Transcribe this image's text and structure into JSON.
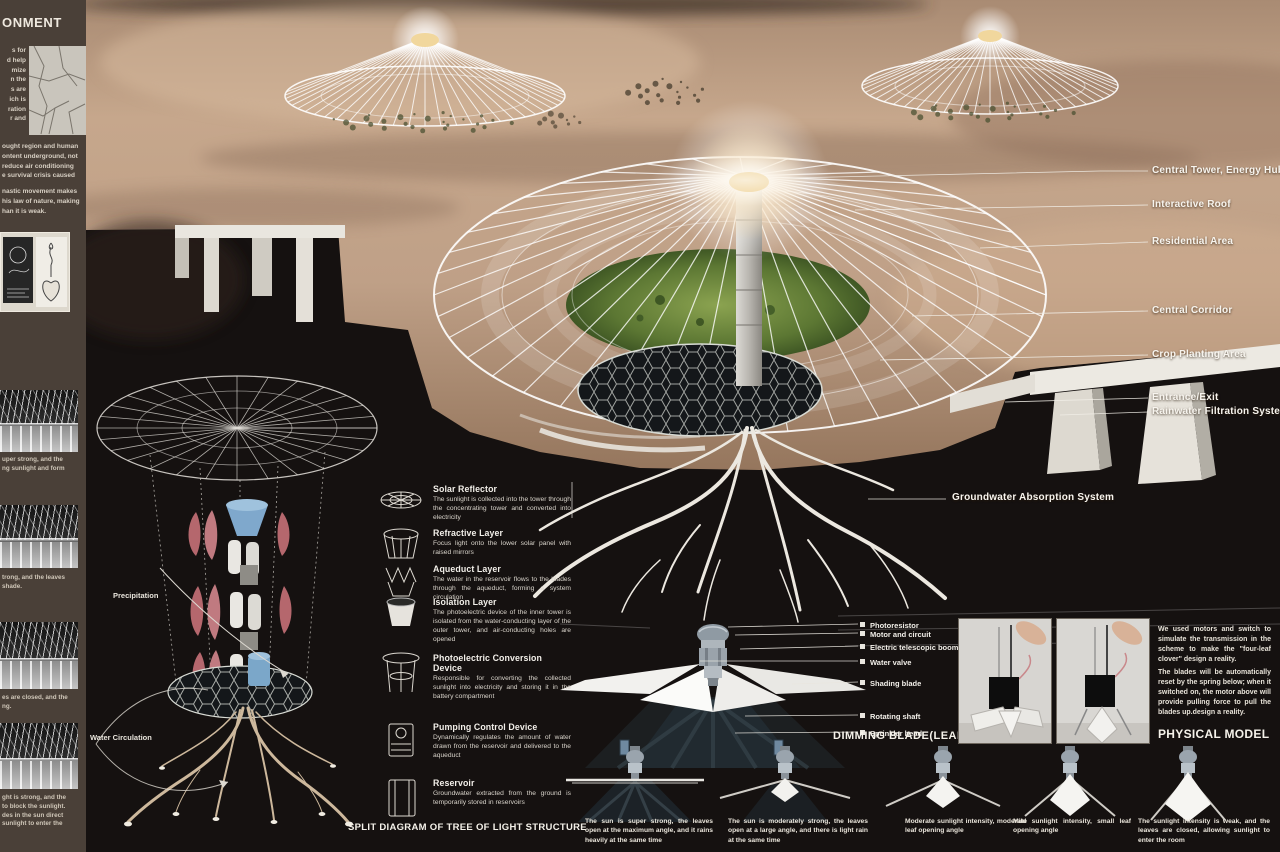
{
  "colors": {
    "sidebar_bg": "#4a4038",
    "board_bg": "#151110",
    "desert_light": "#c8aa90",
    "desert_dark": "#97785f",
    "lawn_green": "#7a9a3f",
    "text": "#f2efe9"
  },
  "sidebar": {
    "header": "ONMENT",
    "para1": "s  for\nd help\nmize\nn the\ns are\nich is\nration\nr and",
    "para2": "ought region and human\nontent underground, not\nreduce air conditioning\ne survival crisis caused",
    "para3": "nastic movement makes\nhis law of nature, making\nhan it is weak.",
    "captions": [
      {
        "text": "uper strong, and the\nng sunlight and form"
      },
      {
        "text": "trong, and the leaves\nshade."
      },
      {
        "text": "es are closed, and the\nng."
      },
      {
        "text": "ght is strong, and the\nto block the sunlight.\ndes in the sun direct\nsunlight to enter the"
      }
    ]
  },
  "render_labels": [
    {
      "label": "Central Tower, Energy Hub"
    },
    {
      "label": "Interactive Roof"
    },
    {
      "label": "Residential Area"
    },
    {
      "label": "Central Corridor"
    },
    {
      "label": "Crop Planting Area"
    },
    {
      "label": "Entrance/Exit"
    },
    {
      "label": "Rainwater Filtration System"
    },
    {
      "label": "Groundwater Absorption System"
    }
  ],
  "split_diagram": {
    "title": "SPLIT DIAGRAM OF TREE OF LIGHT STRUCTURE",
    "precipitation_label": "Precipitation",
    "water_circulation_label": "Water Circulation",
    "components": [
      {
        "name": "Solar Reflector",
        "desc": "The sunlight is collected into the tower through the concentrating tower and converted into electricity"
      },
      {
        "name": "Refractive Layer",
        "desc": "Focus light onto the lower solar panel with raised mirrors"
      },
      {
        "name": "Aqueduct Layer",
        "desc": "The water in the reservoir flows to the blades through the aqueduct, forming a system circulation"
      },
      {
        "name": "Isolation Layer",
        "desc": "The photoelectric device of the inner tower is isolated from the water-conducting layer of the outer tower, and air-conducting holes are opened"
      },
      {
        "name": "Photoelectric Conversion Device",
        "desc": "Responsible for converting the collected sunlight into electricity and storing it in the battery compartment"
      },
      {
        "name": "Pumping Control Device",
        "desc": "Dynamically regulates the amount of water drawn from the reservoir and delivered to the aqueduct"
      },
      {
        "name": "Reservoir",
        "desc": "Groundwater extracted from the ground is temporarily stored in reservoirs"
      }
    ]
  },
  "dimming_blade": {
    "title": "DIMMING BLADE(LEAF)",
    "parts": [
      {
        "label": "Photoresistor"
      },
      {
        "label": "Motor and circuit"
      },
      {
        "label": "Electric telescopic boom"
      },
      {
        "label": "Water valve"
      },
      {
        "label": "Shading blade"
      },
      {
        "label": "Rotating shaft"
      },
      {
        "label": "Sprinkler head"
      }
    ]
  },
  "physical_model": {
    "title": "PHYSICAL MODEL",
    "para1": "We used motors and switch to simulate the transmission in the scheme to make the \"four-leaf clover\" design a reality.",
    "para2": "The blades will be automatically reset by the spring below; when it switched on, the motor above will provide pulling force to pull the blades up.design a reality."
  },
  "stages": [
    {
      "caption": "The sun is super strong, the leaves open at the maximum angle, and it rains heavily at the same time"
    },
    {
      "caption": "The sun is moderately strong, the leaves open at a large angle, and there is light rain at the same time"
    },
    {
      "caption": "Moderate sunlight intensity, moderate leaf opening angle"
    },
    {
      "caption": "Mild sunlight intensity, small leaf opening angle"
    },
    {
      "caption": "The sunlight intensity is weak, and the leaves are closed, allowing sunlight to enter the room"
    }
  ]
}
